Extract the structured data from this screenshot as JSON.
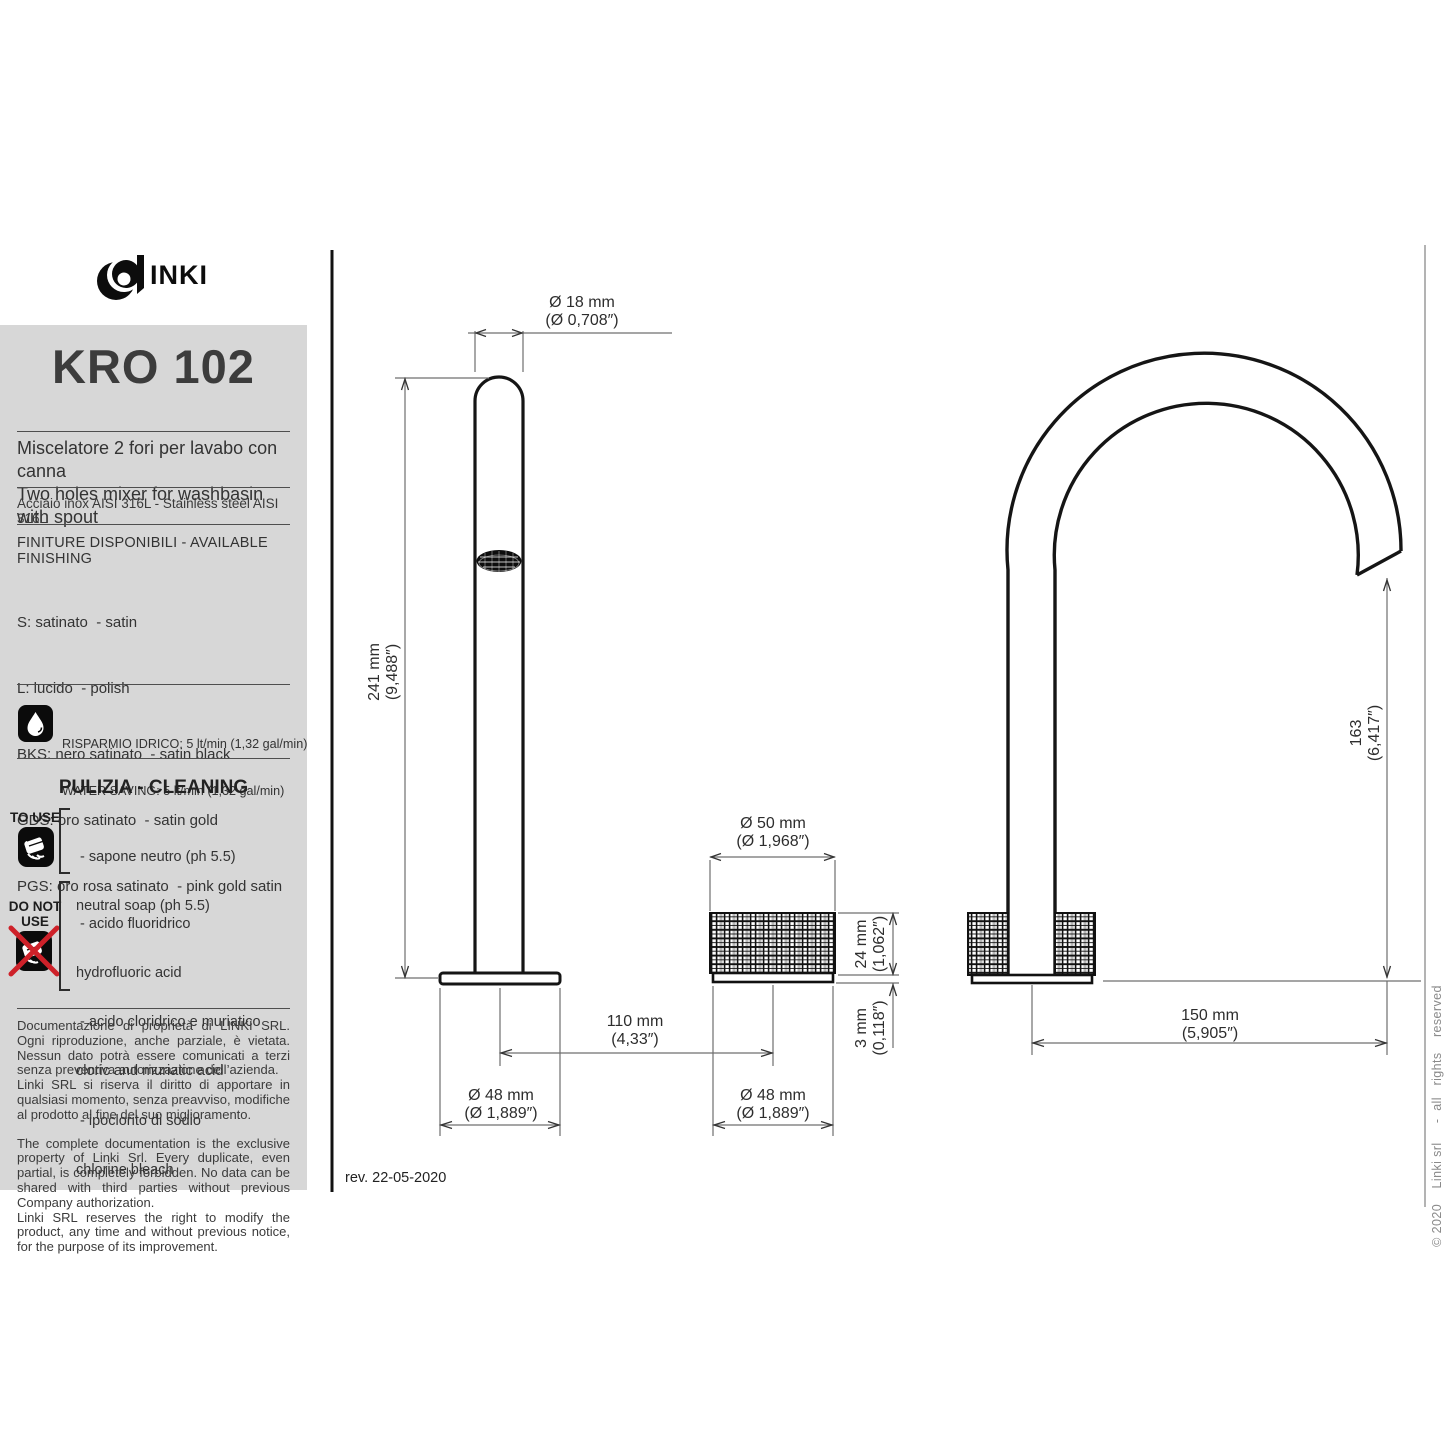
{
  "logo": {
    "text": "INKI"
  },
  "product": {
    "code": "KRO 102",
    "desc_it": "Miscelatore 2 fori per lavabo con canna",
    "desc_en": "Two holes mixer for washbasin with spout",
    "material": "Acciaio inox AISI 316L - Stainless steel AISI 316L"
  },
  "finishes": {
    "heading": "FINITURE DISPONIBILI - AVAILABLE FINISHING",
    "items": [
      "S: satinato  - satin",
      "L: lucido  - polish",
      "BKS: nero satinato  - satin black",
      "GDS: oro satinato  - satin gold",
      "PGS: oro rosa satinato  - pink gold satin"
    ]
  },
  "water_saving": {
    "line_it": "RISPARMIO IDRICO: 5 lt/min (1,32 gal/min)",
    "line_en": "WATER SAVING: 5 lt/min (1,32 gal/min)"
  },
  "cleaning": {
    "heading": "PULIZIA - CLEANING",
    "to_use": {
      "label": "TO USE",
      "items": [
        " - sapone neutro (ph 5.5)",
        "neutral soap (ph 5.5)"
      ]
    },
    "do_not_use": {
      "label_line1": "DO NOT",
      "label_line2": "USE",
      "items": [
        " - acido fluoridrico",
        "hydrofluoric acid",
        " - acido cloridrico e muriatico",
        "cloric and muriatic acid",
        " - ipoclorito di sodio",
        "chlorine bleach"
      ]
    }
  },
  "legal": {
    "it1": "Documentazione di proprietà di LINKI SRL. Ogni riproduzione, anche parziale, è vietata. Nessun dato potrà essere comunicati a terzi senza preventiva autorizzazione dell’azienda.",
    "it2": "Linki SRL si riserva il diritto di apportare in qualsiasi momento, senza preavviso, modifiche al prodotto al fine del suo miglioramento.",
    "en1": "The complete documentation is the exclusive property of Linki Srl. Every duplicate, even partial, is completely forbidden. No data can be shared with third parties without previous Company authorization.",
    "en2": "Linki SRL  reserves the right to modify the product, any time and without previous notice, for the purpose of its improvement."
  },
  "revision": "rev. 22-05-2020",
  "copyright": "© 2020    Linki srl     -  all   rights    reserved",
  "dimensions": {
    "spout_diameter": {
      "mm": "Ø 18 mm",
      "inch": "(Ø 0,708″)"
    },
    "spout_height": {
      "mm": "241 mm",
      "inch": "(9,488″)"
    },
    "handle_diameter": {
      "mm": "Ø 50 mm",
      "inch": "(Ø 1,968″)"
    },
    "handle_height": {
      "mm": "24 mm",
      "inch": "(1,062″)"
    },
    "plate_height": {
      "mm": "3 mm",
      "inch": "(0,118″)"
    },
    "hole_distance": {
      "mm": "110 mm",
      "inch": "(4,33″)"
    },
    "spout_base_diameter": {
      "mm": "Ø 48 mm",
      "inch": "(Ø 1,889″)"
    },
    "handle_base_diameter": {
      "mm": "Ø 48 mm",
      "inch": "(Ø 1,889″)"
    },
    "spout_reach": {
      "mm": "150 mm",
      "inch": "(5,905″)"
    },
    "spout_outlet_height": {
      "mm": "163",
      "inch": "(6,417″)"
    }
  },
  "colors": {
    "sidebar_bg": "#d7d7d7",
    "accent_red": "#ce2129",
    "line": "#151515"
  }
}
